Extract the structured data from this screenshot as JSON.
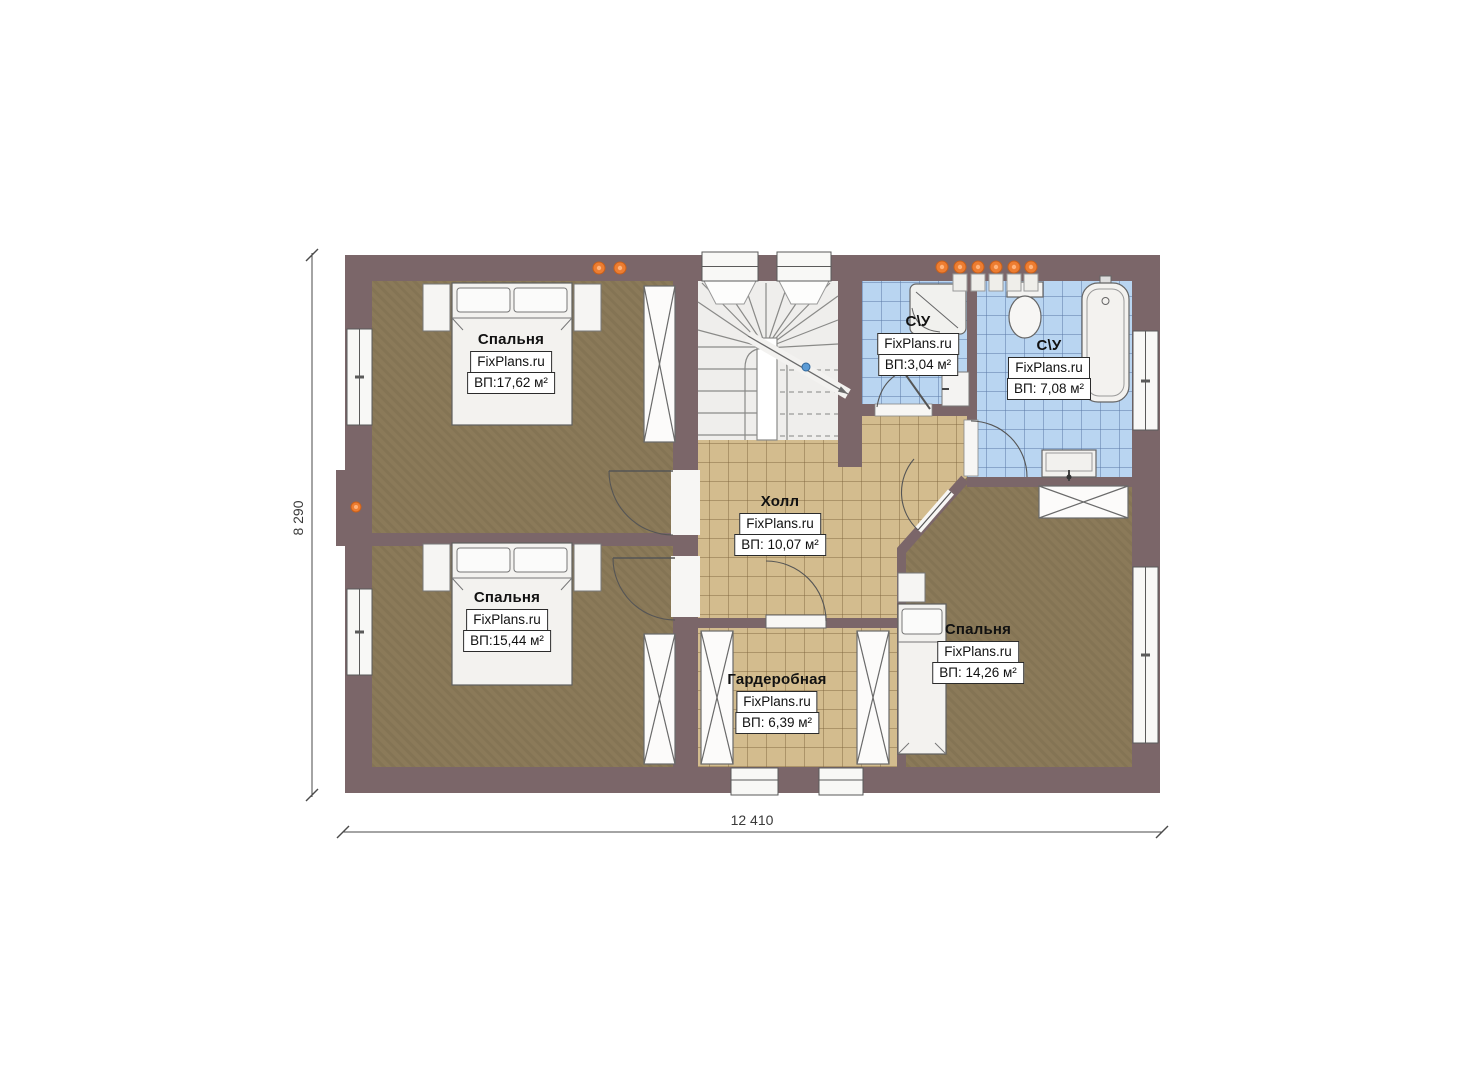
{
  "brand": "FixPlans.ru",
  "rooms": {
    "bedroom_top_left": {
      "name": "Спальня",
      "area": "ВП:17,62 м²"
    },
    "bedroom_bottom_left": {
      "name": "Спальня",
      "area": "ВП:15,44 м²"
    },
    "bedroom_right": {
      "name": "Спальня",
      "area": "ВП: 14,26 м²"
    },
    "hall": {
      "name": "Холл",
      "area": "ВП: 10,07 м²"
    },
    "wardrobe_room": {
      "name": "Гардеробная",
      "area": "ВП: 6,39 м²"
    },
    "bathroom_small": {
      "name": "С\\У",
      "area": "ВП:3,04 м²"
    },
    "bathroom_large": {
      "name": "С\\У",
      "area": "ВП: 7,08 м²"
    }
  },
  "dimensions": {
    "height": "8 290",
    "width": "12 410"
  },
  "colors": {
    "wall": "#7b6669",
    "bedroom_floor": "#8b7a59",
    "hall_floor": "#d3bc8e",
    "bathroom_floor": "#b9d5f1",
    "accent_orange": "#ed7d31"
  }
}
